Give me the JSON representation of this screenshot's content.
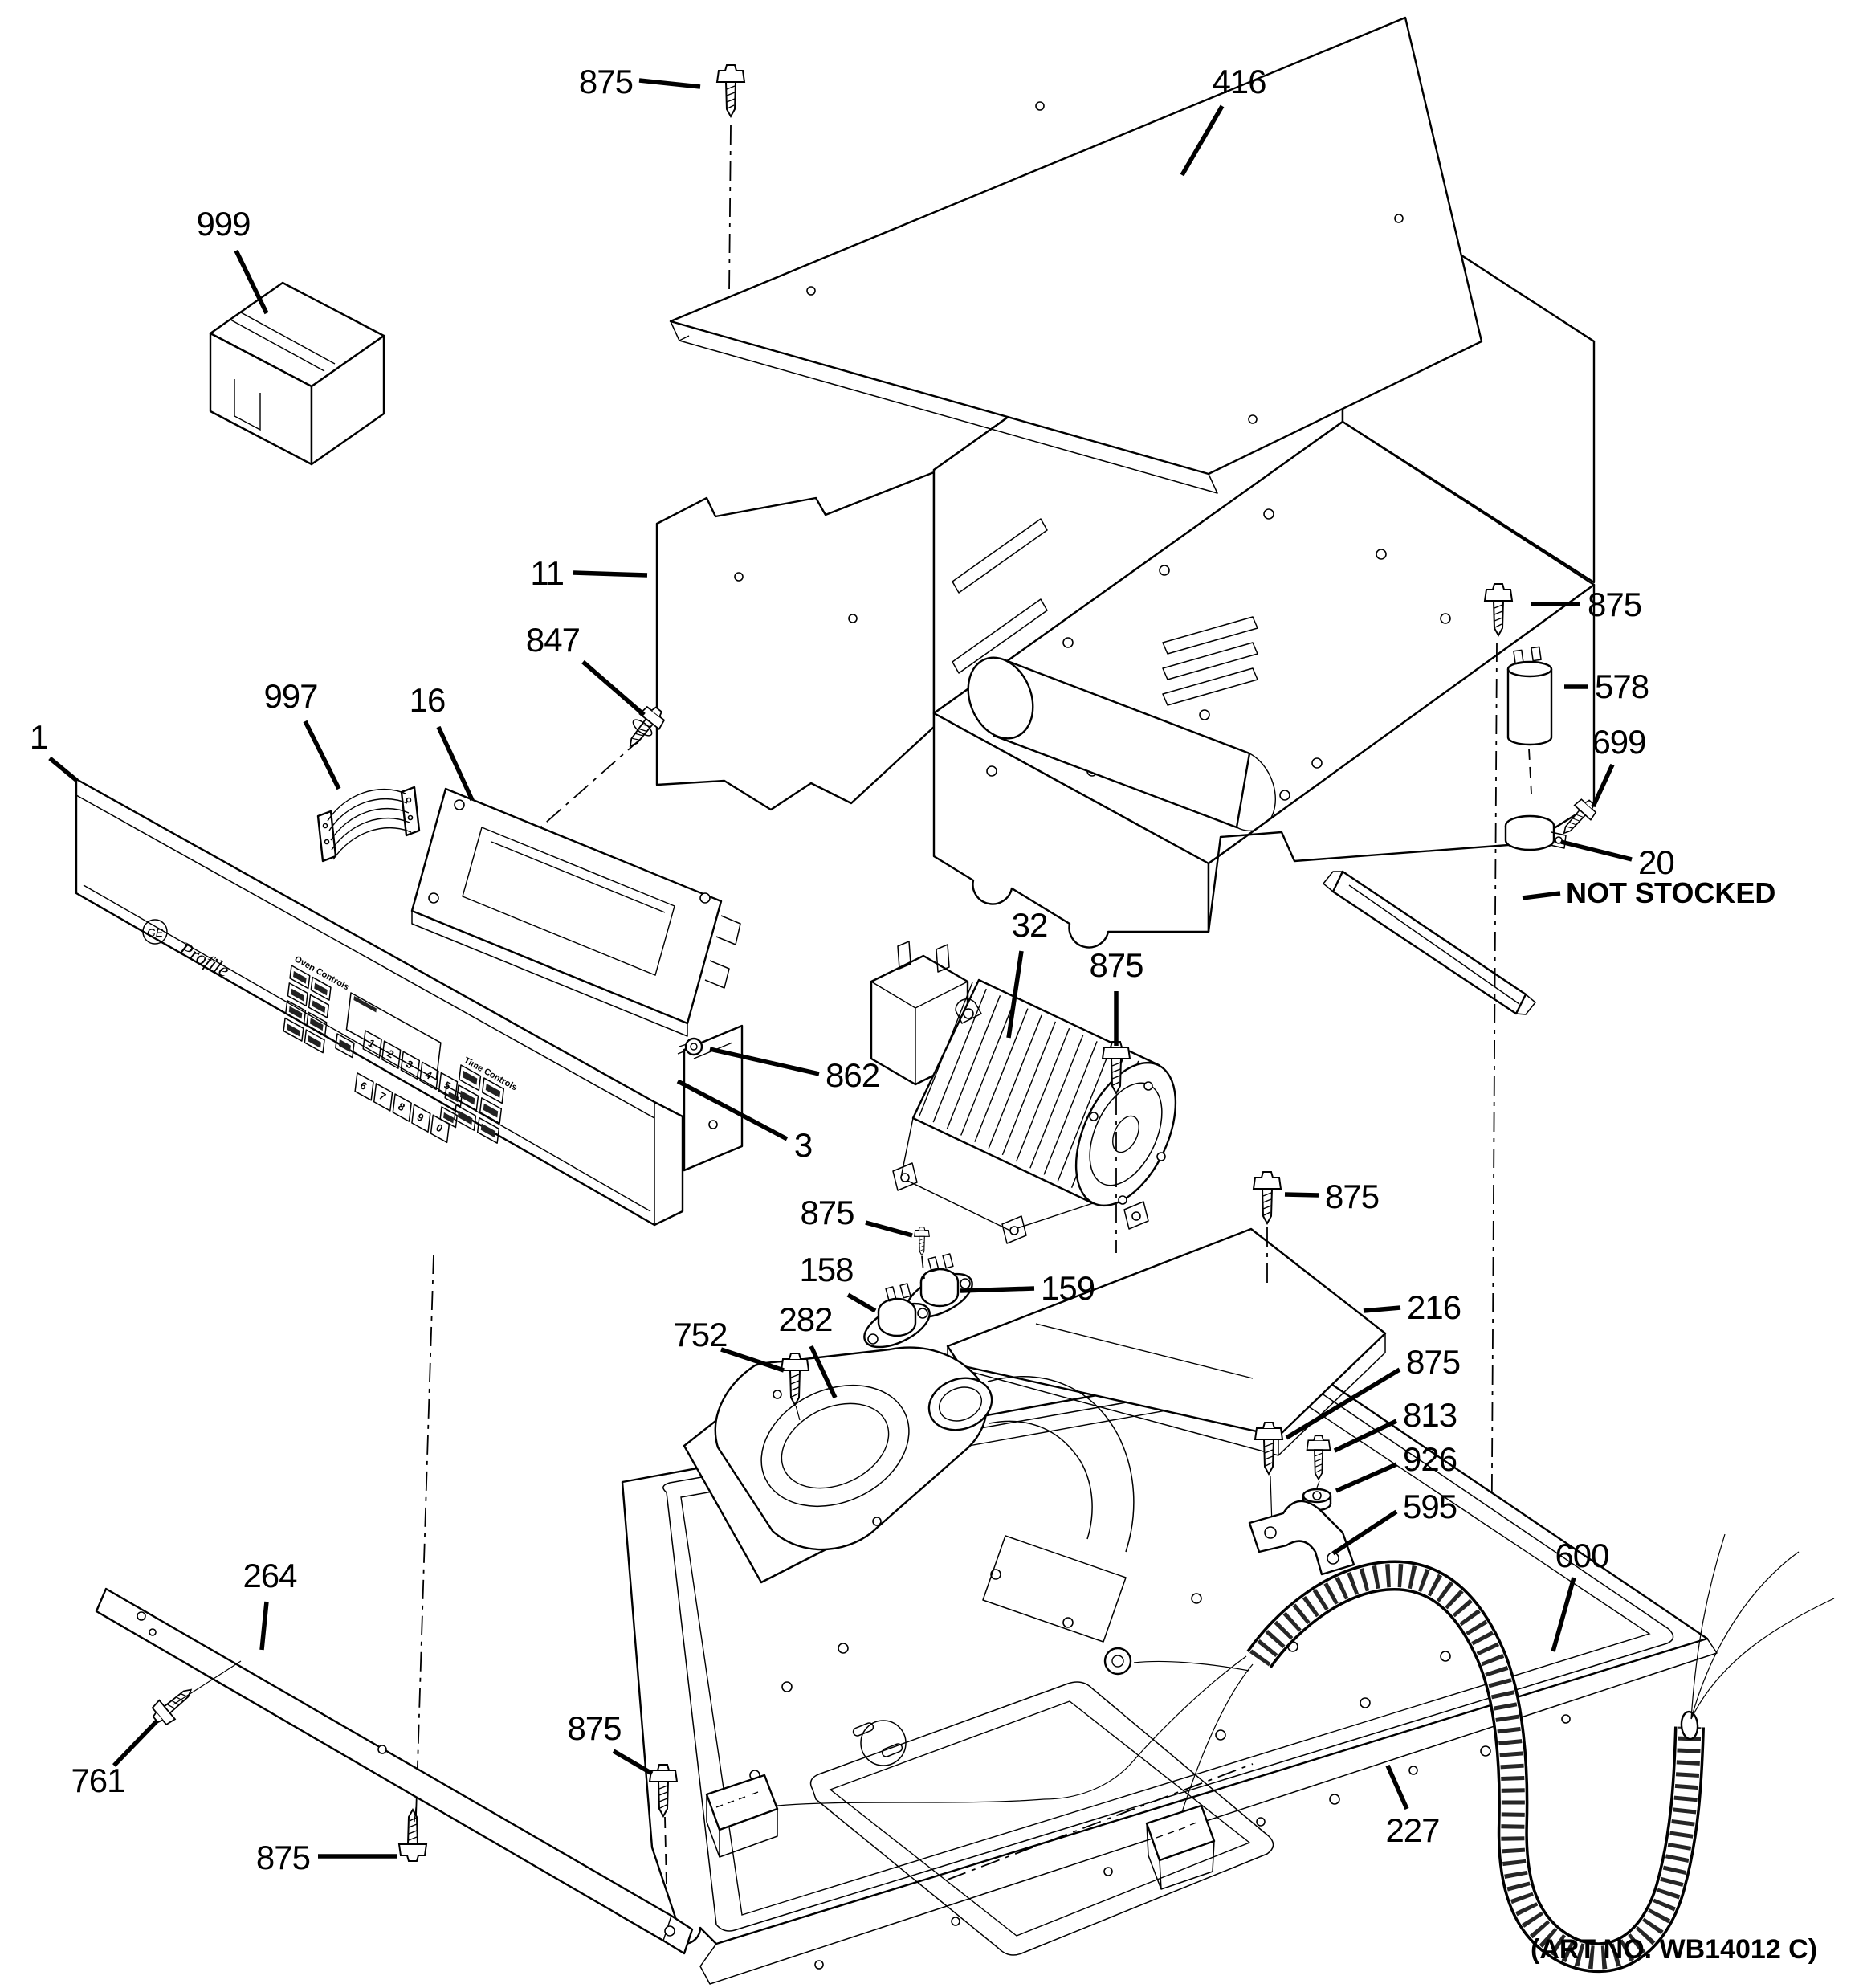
{
  "art_no": "(ART NO. WB14012 C)",
  "brand": {
    "logo": "GE",
    "series": "Profile"
  },
  "panel": {
    "oven_controls_label": "Oven Controls",
    "time_controls_label": "Time Controls",
    "digits": [
      "1",
      "2",
      "3",
      "4",
      "5",
      "6",
      "7",
      "8",
      "9",
      "0"
    ]
  },
  "callouts": [
    {
      "label": "875",
      "x": 788,
      "y": 116,
      "anchor": "end",
      "leader": [
        796,
        100,
        872,
        108
      ]
    },
    {
      "label": "416",
      "x": 1543,
      "y": 116,
      "anchor": "middle",
      "leader": [
        1522,
        132,
        1472,
        218
      ]
    },
    {
      "label": "999",
      "x": 278,
      "y": 293,
      "anchor": "middle",
      "leader": [
        294,
        312,
        332,
        390
      ]
    },
    {
      "label": "11",
      "x": 702,
      "y": 728,
      "anchor": "end",
      "leader": [
        714,
        713,
        806,
        716
      ]
    },
    {
      "label": "847",
      "x": 722,
      "y": 811,
      "anchor": "end",
      "leader": [
        726,
        824,
        802,
        890
      ]
    },
    {
      "label": "997",
      "x": 362,
      "y": 881,
      "anchor": "middle",
      "leader": [
        380,
        898,
        422,
        982
      ]
    },
    {
      "label": "16",
      "x": 532,
      "y": 886,
      "anchor": "middle",
      "leader": [
        546,
        905,
        588,
        996
      ]
    },
    {
      "label": "1",
      "x": 48,
      "y": 932,
      "anchor": "middle",
      "leader": [
        62,
        944,
        96,
        972
      ]
    },
    {
      "label": "875",
      "x": 1977,
      "y": 767,
      "anchor": "start",
      "leader": [
        1968,
        752,
        1906,
        752
      ]
    },
    {
      "label": "578",
      "x": 1986,
      "y": 869,
      "anchor": "start",
      "leader": [
        1978,
        855,
        1948,
        855
      ]
    },
    {
      "label": "699",
      "x": 2016,
      "y": 938,
      "anchor": "middle",
      "leader": [
        2008,
        952,
        1984,
        1004
      ]
    },
    {
      "label": "20",
      "x": 2040,
      "y": 1088,
      "anchor": "start",
      "leader": [
        2032,
        1070,
        1944,
        1048
      ]
    },
    {
      "label": "NOT STOCKED",
      "x": 1950,
      "y": 1124,
      "anchor": "start",
      "bold": true,
      "leader": [
        1943,
        1112,
        1896,
        1118
      ]
    },
    {
      "label": "32",
      "x": 1282,
      "y": 1166,
      "anchor": "middle",
      "leader": [
        1272,
        1184,
        1256,
        1292
      ]
    },
    {
      "label": "875",
      "x": 1390,
      "y": 1216,
      "anchor": "middle",
      "leader": [
        1390,
        1234,
        1390,
        1302
      ]
    },
    {
      "label": "862",
      "x": 1028,
      "y": 1353,
      "anchor": "start",
      "leader": [
        1020,
        1337,
        884,
        1306
      ]
    },
    {
      "label": "3",
      "x": 1000,
      "y": 1440,
      "anchor": "middle",
      "leader": [
        980,
        1418,
        844,
        1346
      ]
    },
    {
      "label": "875",
      "x": 1030,
      "y": 1524,
      "anchor": "middle",
      "leader": [
        1078,
        1522,
        1136,
        1538
      ]
    },
    {
      "label": "158",
      "x": 1029,
      "y": 1595,
      "anchor": "middle",
      "leader": [
        1056,
        1612,
        1090,
        1632
      ]
    },
    {
      "label": "159",
      "x": 1296,
      "y": 1618,
      "anchor": "start",
      "leader": [
        1288,
        1604,
        1196,
        1607
      ]
    },
    {
      "label": "282",
      "x": 1003,
      "y": 1657,
      "anchor": "middle",
      "leader": [
        1010,
        1676,
        1040,
        1740
      ]
    },
    {
      "label": "752",
      "x": 872,
      "y": 1676,
      "anchor": "middle",
      "leader": [
        898,
        1680,
        976,
        1706
      ]
    },
    {
      "label": "216",
      "x": 1752,
      "y": 1642,
      "anchor": "start",
      "leader": [
        1744,
        1628,
        1698,
        1632
      ]
    },
    {
      "label": "875",
      "x": 1650,
      "y": 1504,
      "anchor": "start",
      "leader": [
        1642,
        1488,
        1600,
        1487
      ]
    },
    {
      "label": "875",
      "x": 1751,
      "y": 1710,
      "anchor": "start",
      "leader": [
        1743,
        1705,
        1602,
        1790
      ]
    },
    {
      "label": "813",
      "x": 1747,
      "y": 1776,
      "anchor": "start",
      "leader": [
        1739,
        1769,
        1662,
        1806
      ]
    },
    {
      "label": "926",
      "x": 1747,
      "y": 1831,
      "anchor": "start",
      "leader": [
        1739,
        1823,
        1664,
        1856
      ]
    },
    {
      "label": "595",
      "x": 1747,
      "y": 1890,
      "anchor": "start",
      "leader": [
        1739,
        1882,
        1660,
        1934
      ]
    },
    {
      "label": "600",
      "x": 1970,
      "y": 1951,
      "anchor": "middle",
      "leader": [
        1960,
        1964,
        1934,
        2056
      ]
    },
    {
      "label": "264",
      "x": 336,
      "y": 1976,
      "anchor": "middle",
      "leader": [
        332,
        1994,
        326,
        2054
      ]
    },
    {
      "label": "761",
      "x": 122,
      "y": 2231,
      "anchor": "middle",
      "leader": [
        142,
        2198,
        196,
        2142
      ]
    },
    {
      "label": "875",
      "x": 740,
      "y": 2166,
      "anchor": "middle",
      "leader": [
        764,
        2180,
        812,
        2208
      ]
    },
    {
      "label": "875",
      "x": 386,
      "y": 2327,
      "anchor": "end",
      "leader": [
        396,
        2311,
        494,
        2311
      ]
    },
    {
      "label": "227",
      "x": 1759,
      "y": 2293,
      "anchor": "middle",
      "leader": [
        1752,
        2252,
        1728,
        2198
      ]
    }
  ]
}
